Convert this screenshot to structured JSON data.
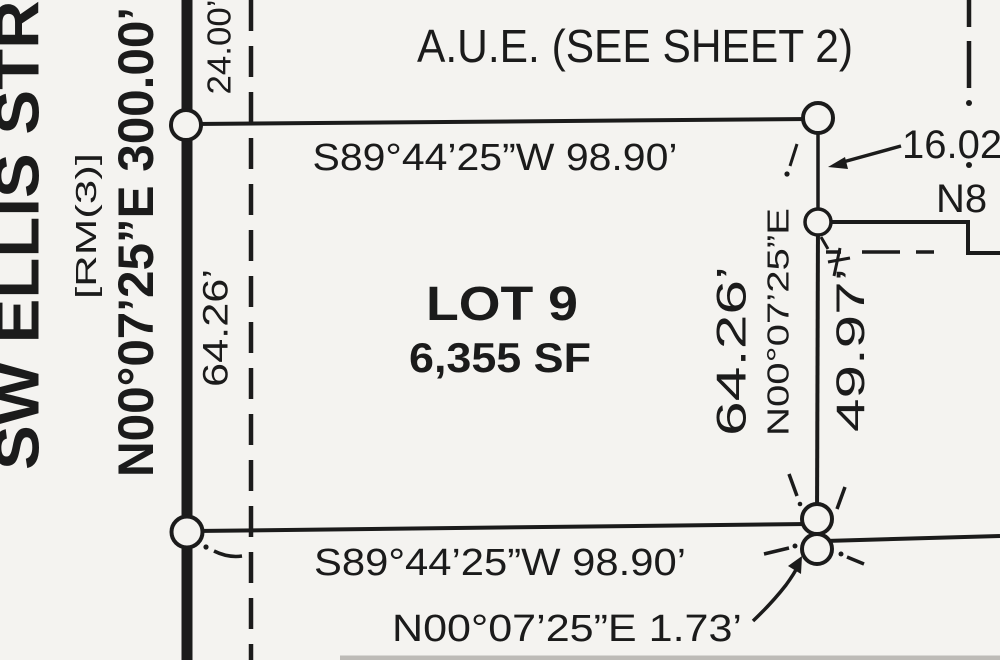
{
  "colors": {
    "ink": "#1b1b1b",
    "paper": "#f4f3f0"
  },
  "street": {
    "name": "SW ELLIS STREET",
    "bearing_distance": "N00°07’25”E 300.00’",
    "reference_monument": "[RM(3)]"
  },
  "easement": {
    "label": "A.U.E. (SEE SHEET 2)"
  },
  "lot": {
    "name": "LOT 9",
    "area": "6,355 SF"
  },
  "boundaries": {
    "north": "S89°44’25”W 98.90’",
    "south": "S89°44’25”W 98.90’",
    "east_bearing": "N00°07’25”E",
    "east_length": "64.26’",
    "west_length": "64.26’",
    "east_south_length": "49.97’",
    "north_offset": "24.00’"
  },
  "ties": {
    "north_tie": "16.02",
    "south_tie": "N00°07’25”E 1.73’",
    "partial_bearing": "N8"
  }
}
